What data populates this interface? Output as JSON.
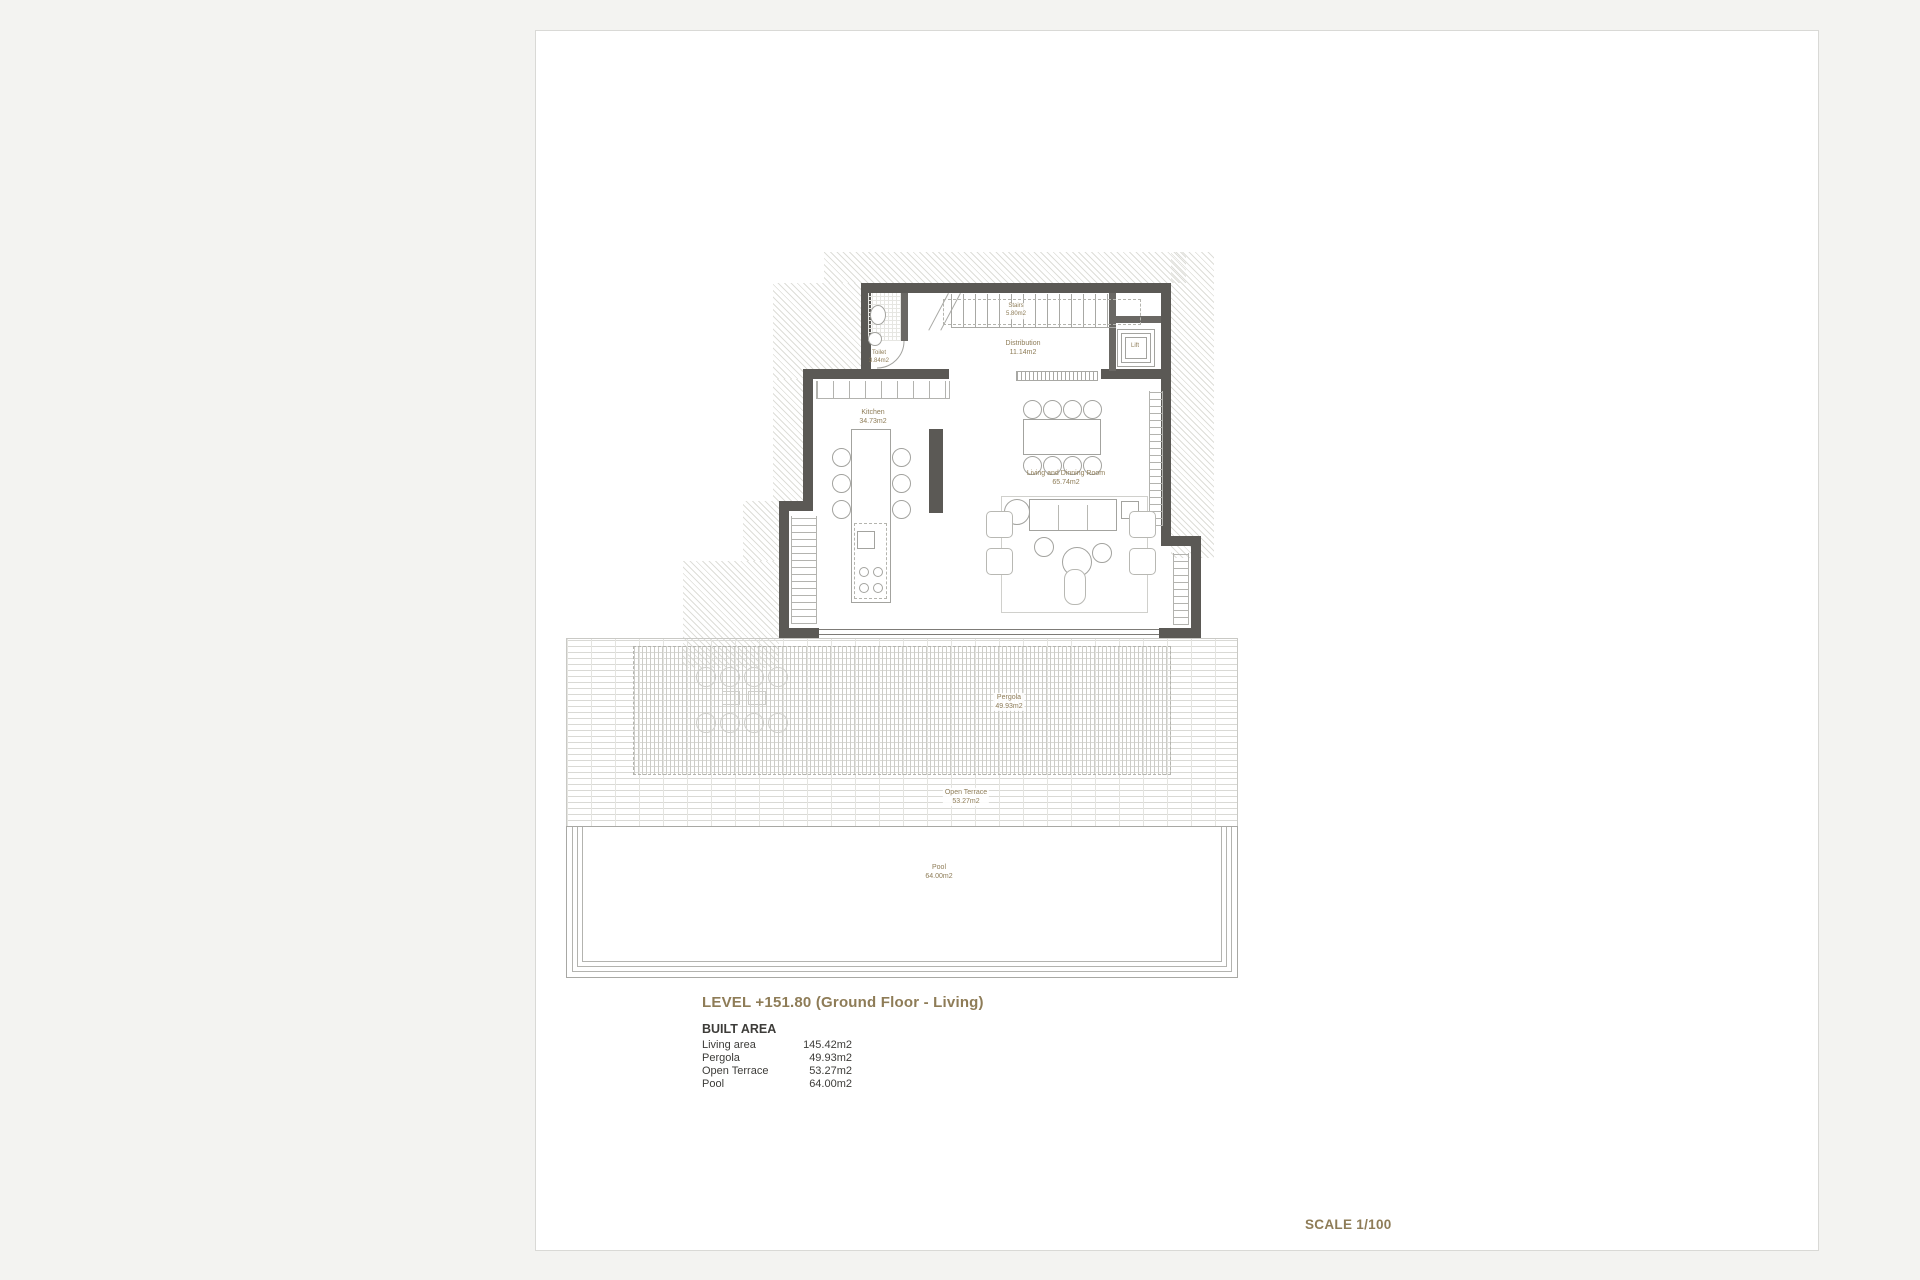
{
  "page": {
    "title_line": "LEVEL +151.80 (Ground Floor - Living)",
    "scale_label": "SCALE 1/100"
  },
  "plan": {
    "rooms": {
      "toilet": {
        "name": "Toilet",
        "area": "3.84m2"
      },
      "stairs": {
        "name": "Stairs",
        "area": "5.80m2"
      },
      "distribution": {
        "name": "Distribution",
        "area": "11.14m2"
      },
      "lift": {
        "name": "Lift"
      },
      "kitchen": {
        "name": "Kitchen",
        "area": "34.73m2"
      },
      "living": {
        "name": "Living and Dinning Room",
        "area": "65.74m2"
      },
      "pergola": {
        "name": "Pergola",
        "area": "49.93m2"
      },
      "open_terrace": {
        "name": "Open Terrace",
        "area": "53.27m2"
      },
      "pool": {
        "name": "Pool",
        "area": "64.00m2"
      }
    }
  },
  "built_area": {
    "heading": "BUILT AREA",
    "rows": [
      {
        "label": "Living area",
        "value": "145.42m2"
      },
      {
        "label": "Pergola",
        "value": "49.93m2"
      },
      {
        "label": "Open Terrace",
        "value": "53.27m2"
      },
      {
        "label": "Pool",
        "value": "64.00m2"
      }
    ]
  },
  "colors": {
    "accent": "#8e7c57",
    "wall": "#5b5955",
    "text": "#3d3c39"
  }
}
